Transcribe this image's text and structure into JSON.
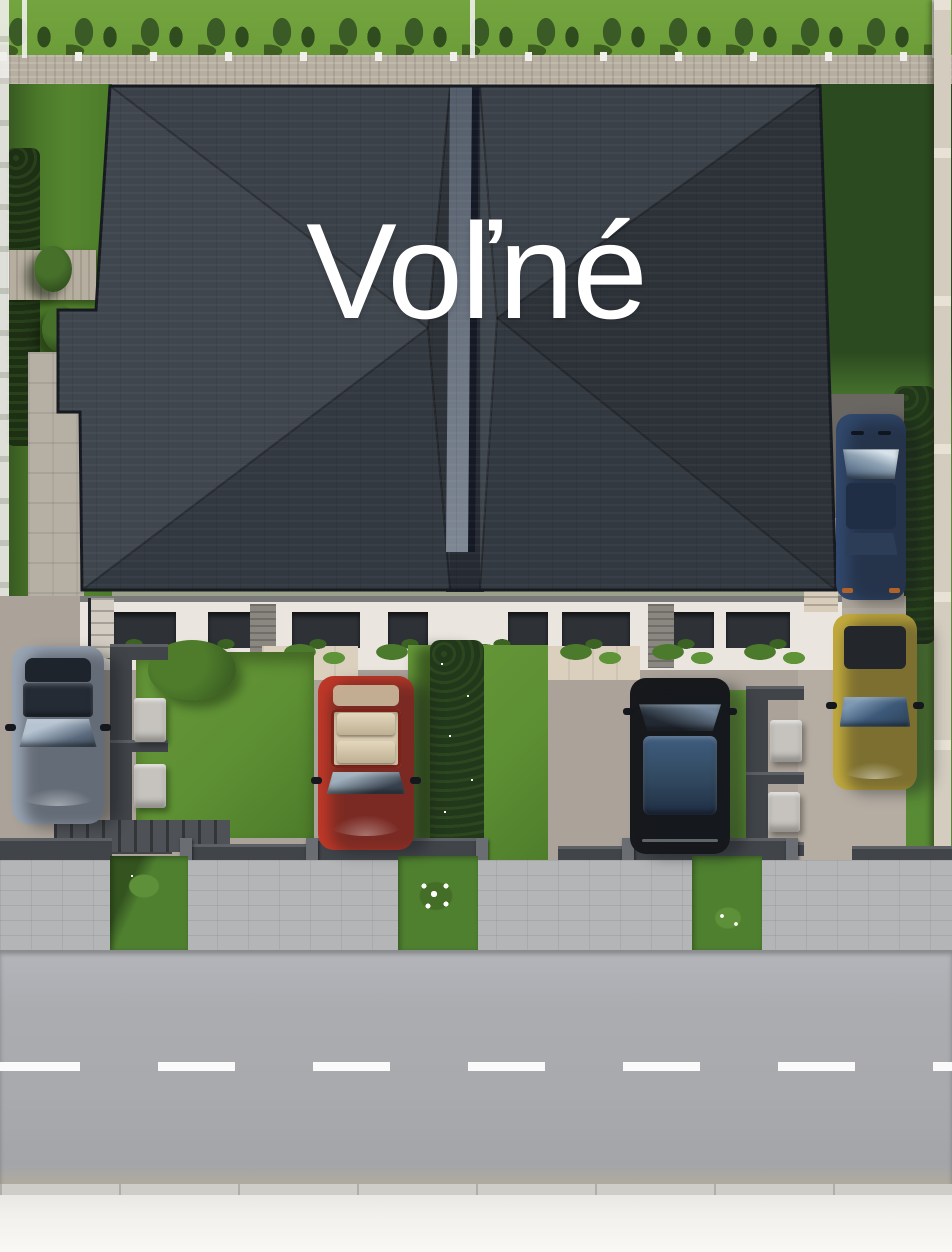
{
  "overlay": {
    "label": "Voľné"
  },
  "palette": {
    "label-white": "#ffffff",
    "roof-top-face": "#3b4149",
    "roof-left-face": "#40464e",
    "roof-bottom-face": "#333941",
    "roof-right-face": "#2d3239",
    "roof-core": "#262b33",
    "roof-divider-a": "#545d6a",
    "roof-divider-b": "#7e8794",
    "grass-rear": "#74a43e",
    "grass-sun": "#5f9138",
    "grass-shadow": "#4a7829",
    "grass-dark": "#2c4a20",
    "hedge-dark": "#22381a",
    "tree-green": "#3a5a26",
    "gabion-stone": "#b6ae9f",
    "facade": "#eae5df",
    "window-dark": "#2e3237",
    "stone-pillar": "#8a8680",
    "patio-beige": "#dbd0be",
    "pavement": "#aba39a",
    "pavement-light": "#b5ada2",
    "wall-dark": "#41454a",
    "mailbox-light": "#c6c3be",
    "sidewalk": "#b4b5b6",
    "road": "#a8aaae",
    "road-line": "#fafafa",
    "curb-light": "#cfcdc8",
    "pale-strip": "#f2f1ee",
    "stone-wall": "#d3ccbf",
    "fence-white": "#f0efec"
  },
  "cars": [
    {
      "name": "silver-sedan",
      "color": "#9aa5b4",
      "glass": "#242b35"
    },
    {
      "name": "red-convertible",
      "color": "#bf3828",
      "interior": "#d9cbb0"
    },
    {
      "name": "black-suv",
      "color": "#17191d",
      "glass": "#3b5878"
    },
    {
      "name": "gold-hatchback",
      "color": "#c2aa3d",
      "glass": "#3d5a7a"
    },
    {
      "name": "blue-sedan",
      "color": "#31486c",
      "glass": "#a9bac9"
    }
  ]
}
